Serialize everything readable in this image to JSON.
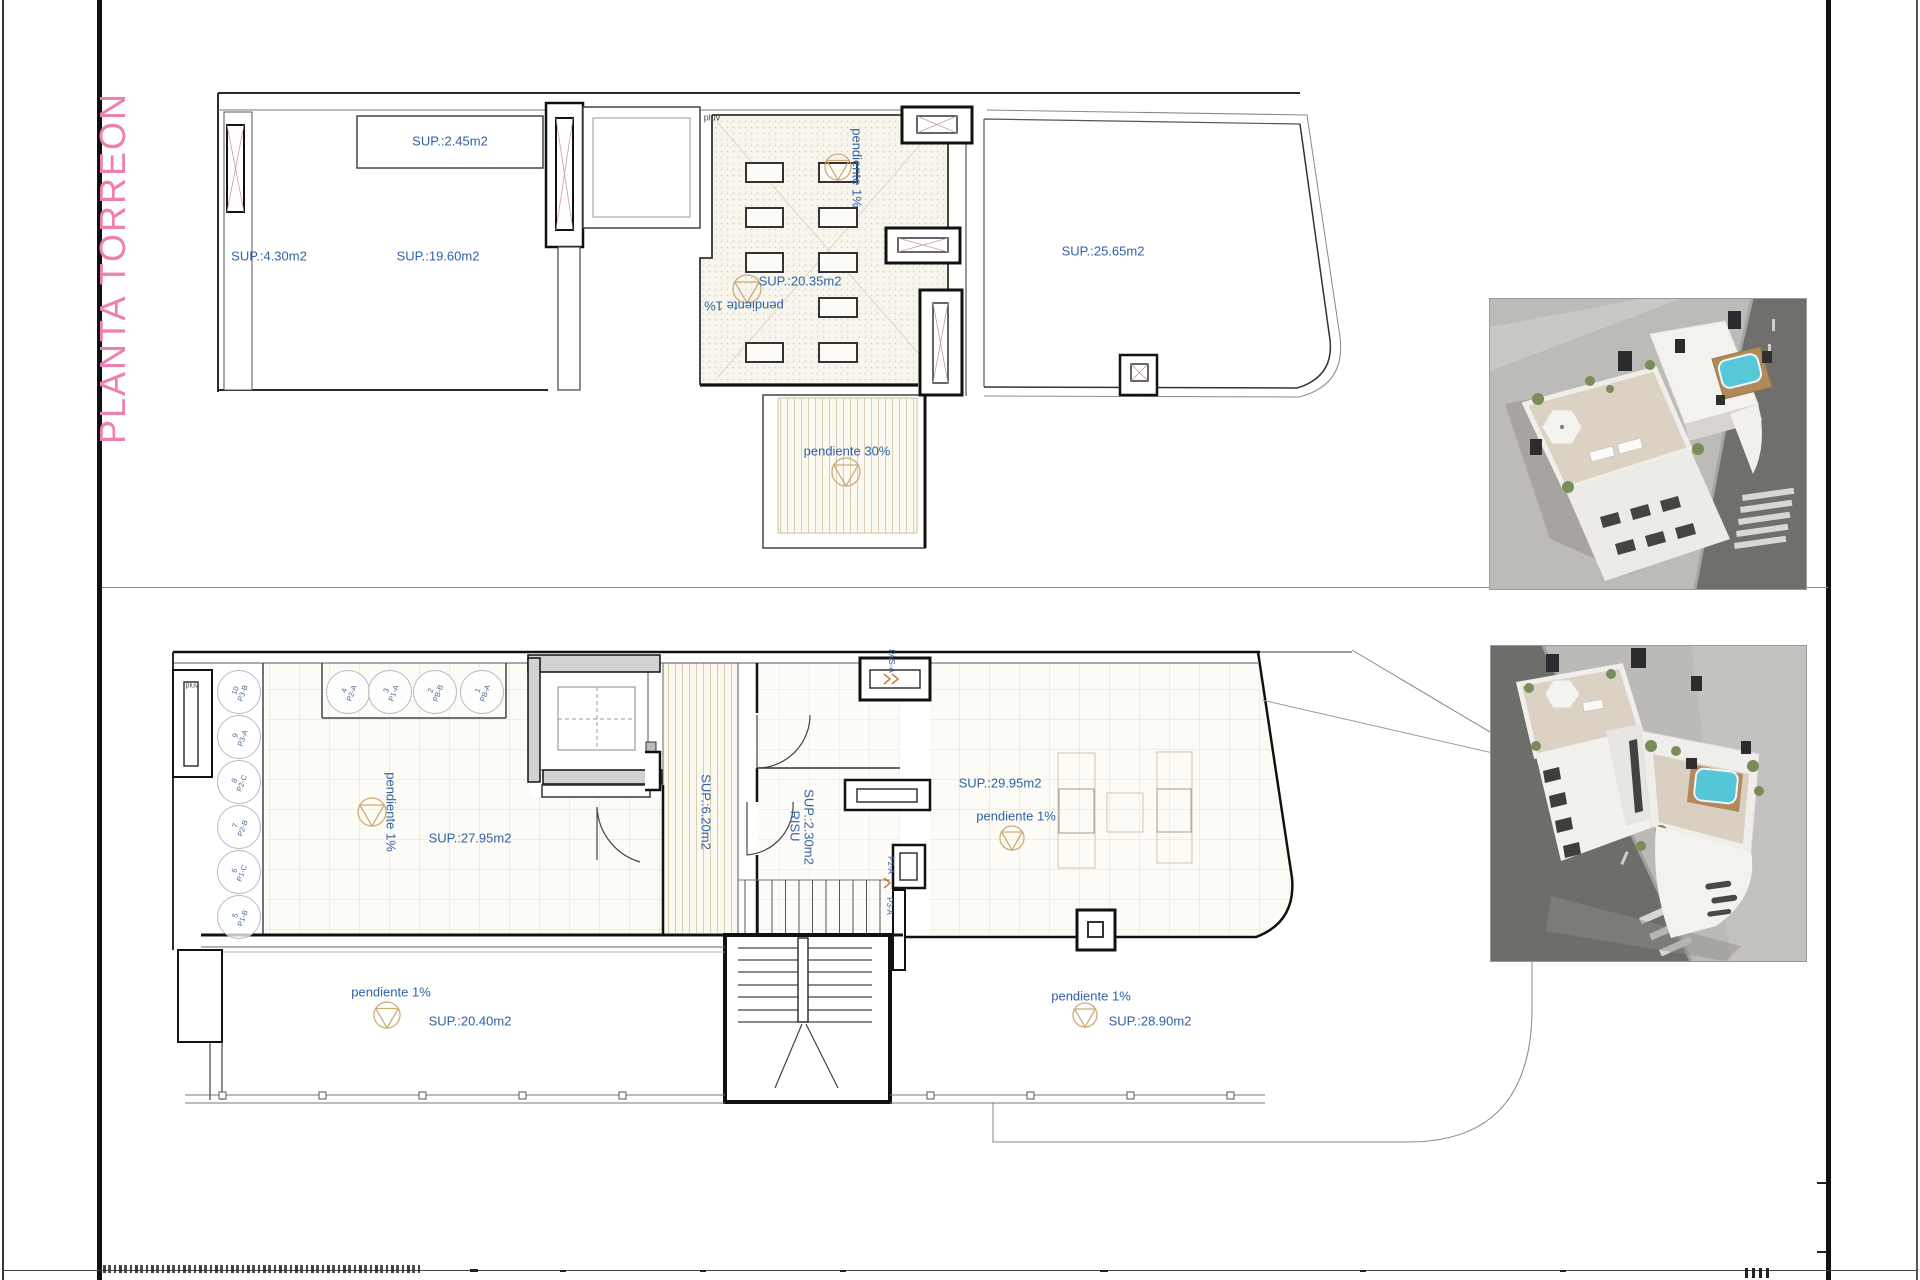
{
  "sheet": {
    "title": "PLANTA TORREON"
  },
  "colors": {
    "accent_blue": "#3361a8",
    "title_pink": "#ee7fae",
    "drain_tan": "#c8a46a"
  },
  "upper_plan": {
    "pluv_label": "pluv",
    "shelf_area": "SUP.:2.45m2",
    "closet_area": "SUP.:4.30m2",
    "left_room_area": "SUP.:19.60m2",
    "center_room_area": "SUP.:20.35m2",
    "right_terrace_area": "SUP.:25.65m2",
    "slope_center": "pendiente 1%",
    "slope_center_2": "pendiente 1%",
    "slope_ramp": "pendiente 30%"
  },
  "lower_plan": {
    "pluv_label": "pluv",
    "storage_left": [
      {
        "number": "10",
        "unit": "P3-B"
      },
      {
        "number": "9",
        "unit": "P3-A"
      },
      {
        "number": "8",
        "unit": "P2-C"
      },
      {
        "number": "7",
        "unit": "P2-B"
      },
      {
        "number": "6",
        "unit": "P1-C"
      },
      {
        "number": "5",
        "unit": "P1-B"
      }
    ],
    "storage_top": [
      {
        "number": "4",
        "unit": "P2-A"
      },
      {
        "number": "3",
        "unit": "P1-A"
      },
      {
        "number": "2",
        "unit": "PB-B"
      },
      {
        "number": "1",
        "unit": "PB-A"
      }
    ],
    "main_area": "SUP.:27.95m2",
    "slope_main": "pendiente 1%",
    "corridor_area": "SUP.:6.20m2",
    "riser_label": "RISU",
    "riser_area": "SUP.:2.30m2",
    "door_pas": "PAS-A",
    "door_p2a": "P2-A",
    "door_p3a": "P3-A",
    "terrace_right_area": "SUP.:29.95m2",
    "slope_terrace_right": "pendiente 1%",
    "slope_bottom_left": "pendiente 1%",
    "bottom_left_area": "SUP.:20.40m2",
    "slope_bottom_right": "pendiente 1%",
    "bottom_right_area": "SUP.:28.90m2"
  }
}
